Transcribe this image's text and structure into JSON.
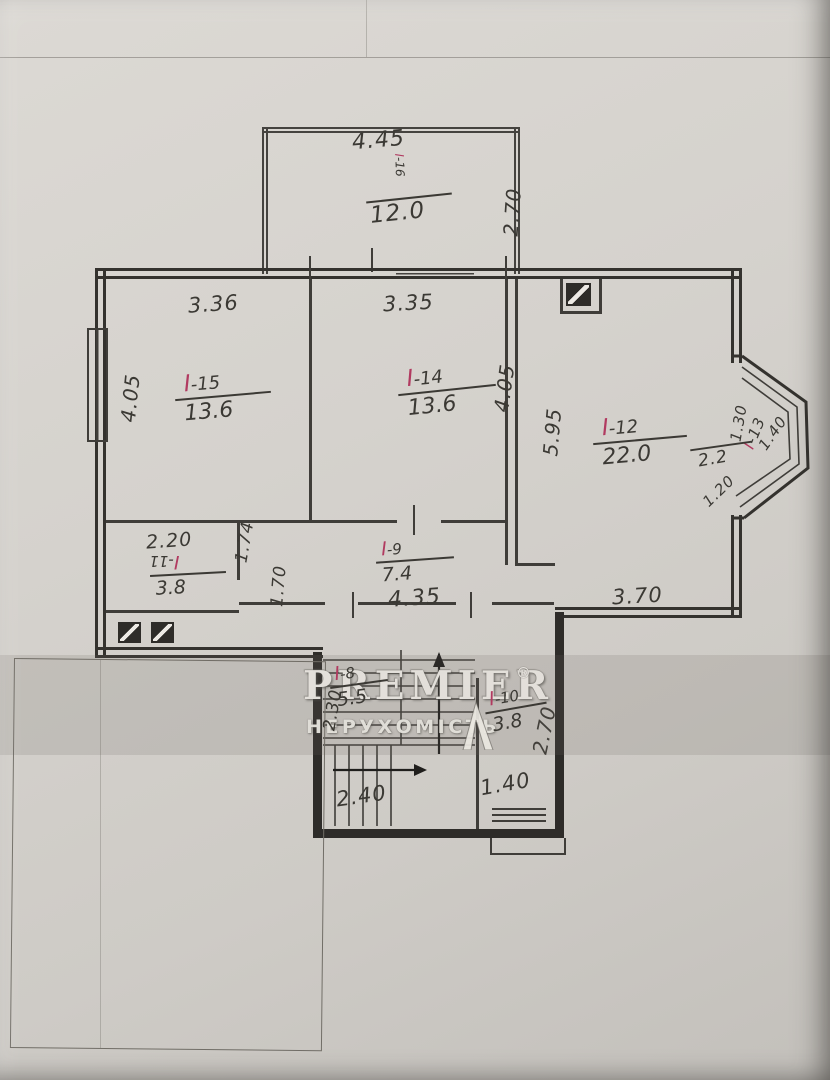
{
  "watermark": {
    "brand": "PREMIER",
    "registered": "®",
    "subtitle": "НЕРУХОМІСТЬ"
  },
  "balcony": {
    "id_prefix": "I",
    "id_suffix": "-16",
    "area": "12.0",
    "width_dim": "4.45",
    "depth_dim": "2.70"
  },
  "rooms": {
    "r15": {
      "id_prefix": "I",
      "id_suffix": "-15",
      "area": "13.6",
      "width_dim": "3.36",
      "height_dim": "4.05"
    },
    "r14": {
      "id_prefix": "I",
      "id_suffix": "-14",
      "area": "13.6",
      "width_dim": "3.35",
      "height_dim": "4.05"
    },
    "r12": {
      "id_prefix": "I",
      "id_suffix": "-12",
      "area": "22.0",
      "height_dim": "5.95",
      "width_dim": "3.70"
    },
    "r13_bay": {
      "id_prefix": "I",
      "id_suffix": "-13",
      "area": "2.2",
      "side_dim": "1.30",
      "top_edge_dim": "1.40",
      "bottom_edge_dim": "1.20"
    },
    "r11": {
      "id_prefix": "I",
      "id_suffix": "-11",
      "area": "3.8",
      "width_dim": "2.20",
      "upper_right_dim": "1.74",
      "lower_right_dim": "1.70"
    },
    "r9": {
      "id_prefix": "I",
      "id_suffix": "-9",
      "area": "7.4",
      "width_dim": "4.35"
    },
    "r8_stairs": {
      "id_prefix": "I",
      "id_suffix": "-8",
      "area": "5.5",
      "height_dim": "2.30",
      "width_dim": "2.40"
    },
    "r10": {
      "id_prefix": "I",
      "id_suffix": "-10",
      "area": "3.8",
      "height_dim": "2.70",
      "width_dim": "1.40"
    }
  }
}
